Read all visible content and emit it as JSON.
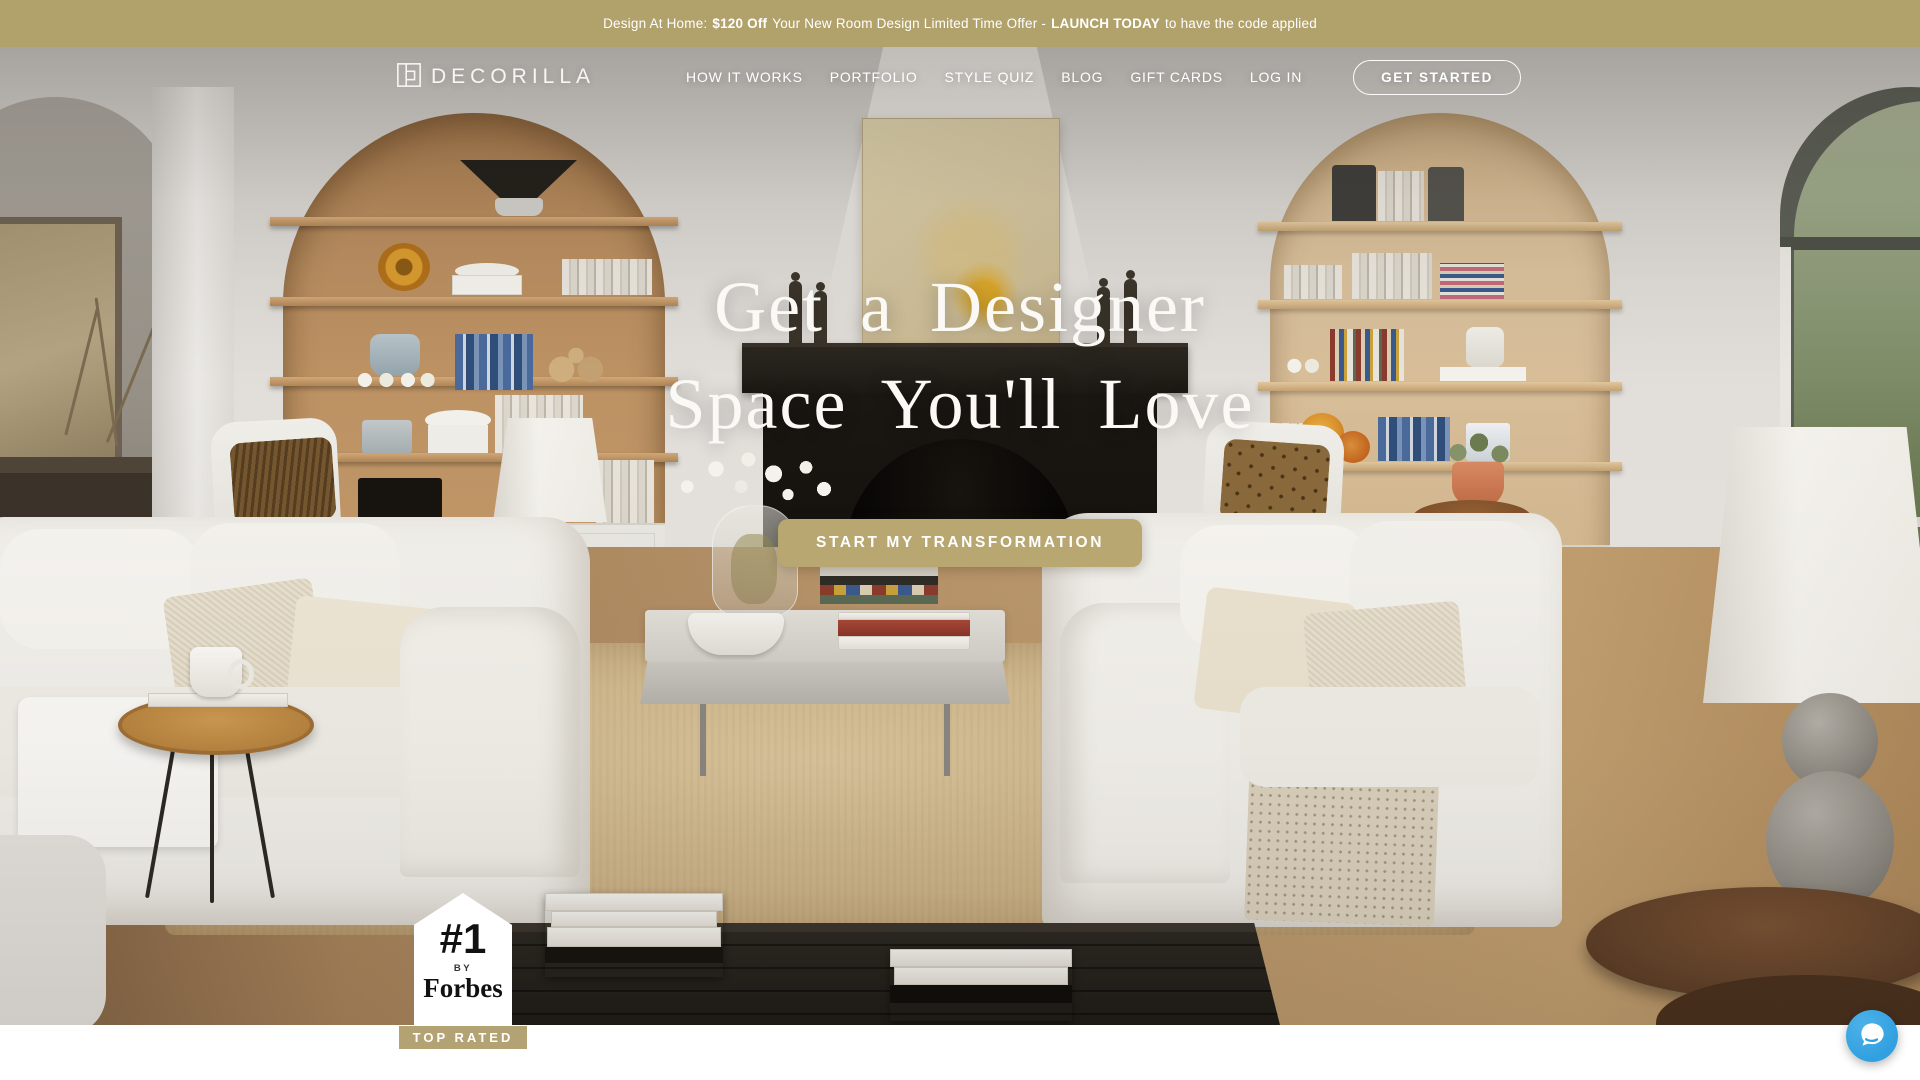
{
  "banner": {
    "part1": "Design At Home:",
    "bold1": "$120 Off",
    "part2": "Your New Room Design Limited Time Offer -",
    "bold2": "LAUNCH TODAY",
    "part3": "to have the code applied"
  },
  "header": {
    "logo_text": "DECORILLA",
    "nav": [
      "HOW IT WORKS",
      "PORTFOLIO",
      "STYLE QUIZ",
      "BLOG",
      "GIFT CARDS"
    ],
    "login_label": "LOG IN",
    "get_started_label": "GET STARTED"
  },
  "hero": {
    "title_line1": "Get a Designer",
    "title_line2": "Space You'll Love",
    "cta_label": "START MY TRANSFORMATION"
  },
  "badge": {
    "rank": "#1",
    "by_label": "BY",
    "source": "Forbes",
    "ribbon": "TOP RATED"
  },
  "colors": {
    "banner_bg": "#b1a16b",
    "cta_gold": "#b8a771",
    "ribbon_gold": "#b3a273",
    "chat_blue": "#31a0e0",
    "nav_text": "#ffffff",
    "hero_text": "#faf9f6"
  }
}
